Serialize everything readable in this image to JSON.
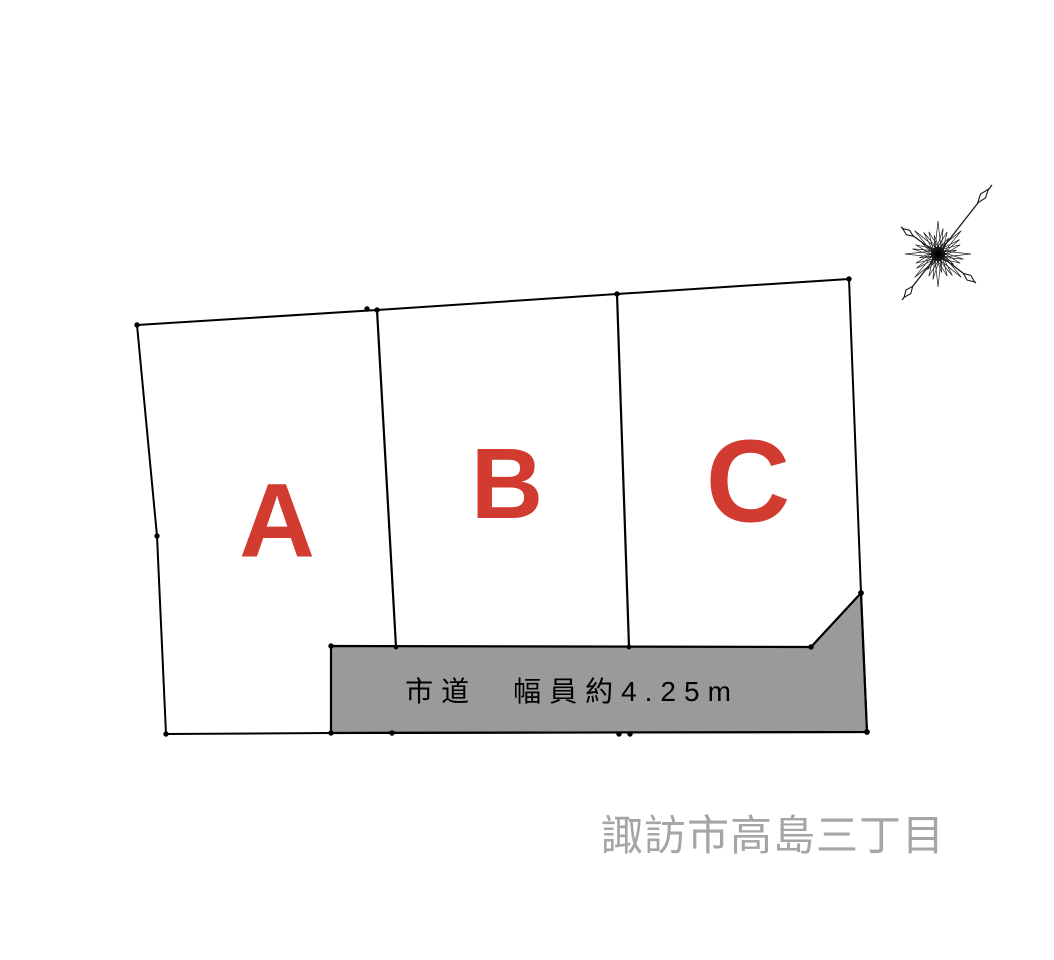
{
  "diagram": {
    "title": "land-plot-layout",
    "plots": [
      {
        "label": "A"
      },
      {
        "label": "B"
      },
      {
        "label": "C"
      }
    ],
    "road": {
      "label": "市道　幅員約4.25m",
      "description_kind": "city-road-width-band"
    },
    "location": {
      "label": "諏訪市高島三丁目"
    }
  },
  "icons": {
    "compass": "compass-rose-north-arrow"
  },
  "colors": {
    "plot_label": "#d23b2f",
    "road_fill": "#9a9a9a",
    "outline": "#000000",
    "location_text": "#a5a5a5",
    "road_label_text": "#000000"
  }
}
